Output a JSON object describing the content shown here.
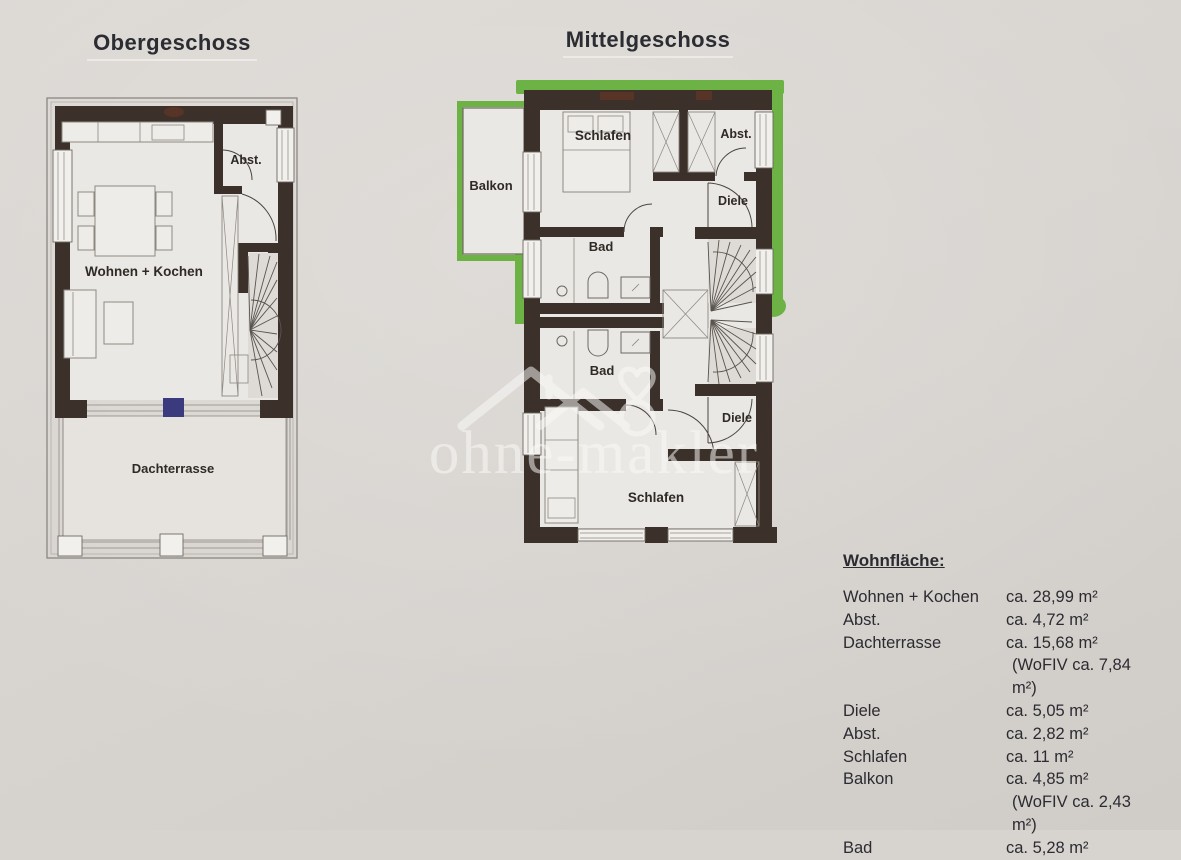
{
  "page": {
    "background_hex": "#d7d3cf",
    "wall_hex": "#3b312a",
    "highlight_green_hex": "#6cb244",
    "marker_blue_hex": "#3c3a7e"
  },
  "plans": {
    "obergeschoss": {
      "title": "Obergeschoss",
      "rooms": {
        "wohnen_kochen": "Wohnen + Kochen",
        "abst": "Abst.",
        "dachterrasse": "Dachterrasse"
      }
    },
    "mittelgeschoss": {
      "title": "Mittelgeschoss",
      "rooms": {
        "balkon": "Balkon",
        "schlafen_top": "Schlafen",
        "abst": "Abst.",
        "diele_top": "Diele",
        "bad_top": "Bad",
        "bad_bottom": "Bad",
        "diele_bottom": "Diele",
        "schlafen_bottom": "Schlafen"
      }
    }
  },
  "watermark": {
    "text": "ohne-makler"
  },
  "area_table": {
    "heading": "Wohnfläche:",
    "rows": [
      {
        "label": "Wohnen + Kochen",
        "value": "ca. 28,99 m²"
      },
      {
        "label": "Abst.",
        "value": "ca. 4,72 m²"
      },
      {
        "label": "Dachterrasse",
        "value": "ca. 15,68 m²",
        "note": "(WoFIV ca. 7,84 m²)"
      },
      {
        "label": "Diele",
        "value": "ca. 5,05 m²"
      },
      {
        "label": "Abst.",
        "value": "ca. 2,82 m²"
      },
      {
        "label": "Schlafen",
        "value": "ca. 11 m²"
      },
      {
        "label": "Balkon",
        "value": "ca. 4,85 m²",
        "note": "(WoFIV ca. 2,43 m²)"
      },
      {
        "label": "Bad",
        "value": "ca. 5,28 m²"
      }
    ]
  }
}
